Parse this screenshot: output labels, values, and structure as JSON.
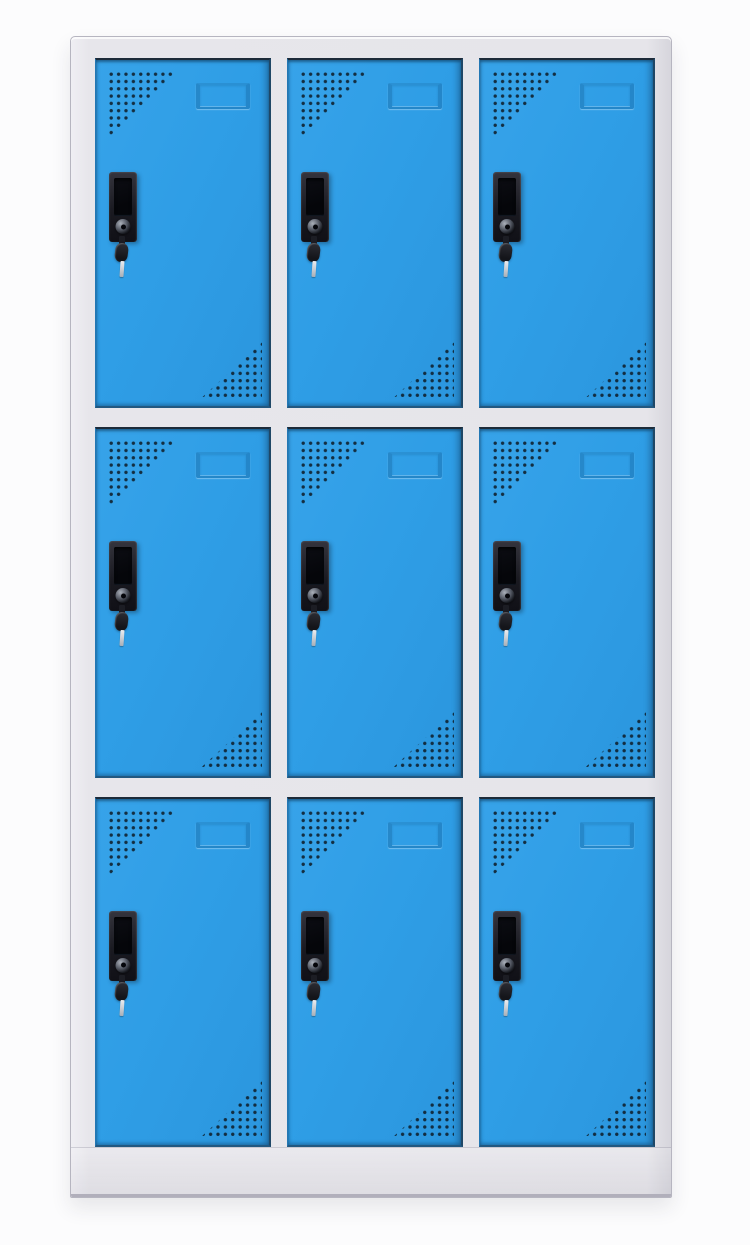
{
  "scene": {
    "type": "product-photograph",
    "object": "nine-door metal locker cabinet with blue doors and light gray frame",
    "background_color": "#fcfcfd",
    "layout": {
      "rows": 3,
      "columns": 3,
      "door_count": 9
    }
  },
  "palette": {
    "door_blue": "#2F9EE6",
    "door_blue_highlight": "#37A3E9",
    "door_edge_shadow": "#1F4766",
    "frame_gray": "#E6E5EA",
    "frame_edge": "#B6B5C0",
    "base_edge": "#B1AFBB",
    "vent_hole_navy": "#102433",
    "handle_black": "#1A1A21",
    "lock_metal": "#8D939D",
    "key_tip_silver": "#D8DCE1"
  },
  "door_features": {
    "vent_top_left": "triangular grid of punched vent holes, top-left corner",
    "vent_bottom_right": "triangular grid of punched vent holes, bottom-right corner",
    "label_holder": "embossed card label frame near top of door",
    "handle": "recessed black pull handle",
    "lock": "round cam-lock cylinder at base of handle",
    "key": "key with silver tip hanging from lock"
  },
  "doors": [
    {
      "id": 1,
      "row": 1,
      "col": 1,
      "label": "Locker door row 1, column 1"
    },
    {
      "id": 2,
      "row": 1,
      "col": 2,
      "label": "Locker door row 1, column 2"
    },
    {
      "id": 3,
      "row": 1,
      "col": 3,
      "label": "Locker door row 1, column 3"
    },
    {
      "id": 4,
      "row": 2,
      "col": 1,
      "label": "Locker door row 2, column 1"
    },
    {
      "id": 5,
      "row": 2,
      "col": 2,
      "label": "Locker door row 2, column 2"
    },
    {
      "id": 6,
      "row": 2,
      "col": 3,
      "label": "Locker door row 2, column 3"
    },
    {
      "id": 7,
      "row": 3,
      "col": 1,
      "label": "Locker door row 3, column 1"
    },
    {
      "id": 8,
      "row": 3,
      "col": 2,
      "label": "Locker door row 3, column 2"
    },
    {
      "id": 9,
      "row": 3,
      "col": 3,
      "label": "Locker door row 3, column 3"
    }
  ]
}
